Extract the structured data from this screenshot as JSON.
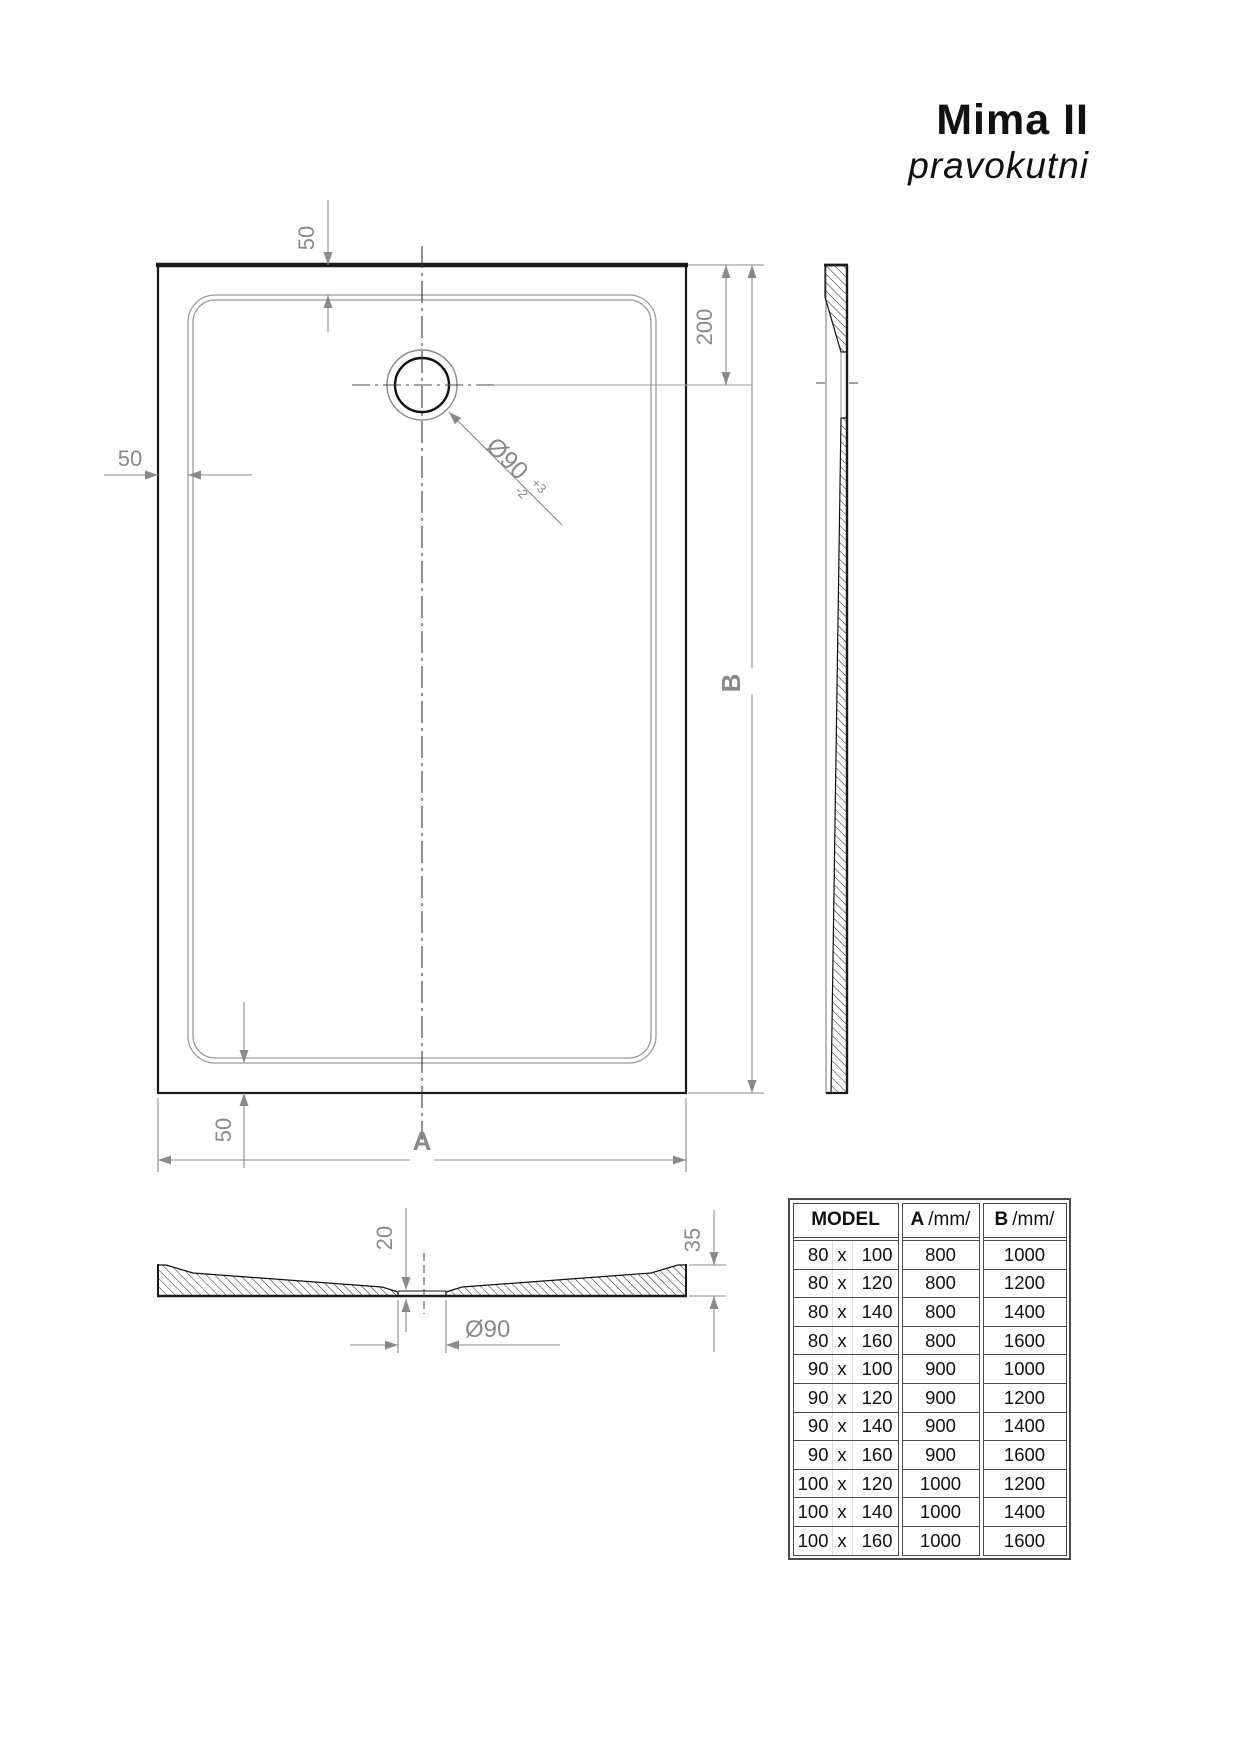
{
  "title": {
    "product": "Mima II",
    "subtitle": "pravokutni"
  },
  "drawing": {
    "top_view": {
      "dim_top_edge_to_rim": "50",
      "dim_left_edge_to_rim": "50",
      "dim_bottom_rim_to_edge": "50",
      "dim_top_edge_to_drain_center": "200",
      "width_label": "A",
      "length_label": "B",
      "drain": {
        "diameter": "Ø90",
        "tol_upper": "+3",
        "tol_lower": "-2"
      }
    },
    "section_view": {
      "thickness_at_drain": "20",
      "thickness_at_edge": "35",
      "drain_diameter": "Ø90"
    }
  },
  "table": {
    "header": {
      "model": "MODEL",
      "a_label": "A",
      "a_unit": "/mm/",
      "b_label": "B",
      "b_unit": "/mm/"
    },
    "rows": [
      {
        "w": "80",
        "sep": "x",
        "l": "100",
        "a": "800",
        "b": "1000"
      },
      {
        "w": "80",
        "sep": "x",
        "l": "120",
        "a": "800",
        "b": "1200"
      },
      {
        "w": "80",
        "sep": "x",
        "l": "140",
        "a": "800",
        "b": "1400"
      },
      {
        "w": "80",
        "sep": "x",
        "l": "160",
        "a": "800",
        "b": "1600"
      },
      {
        "w": "90",
        "sep": "x",
        "l": "100",
        "a": "900",
        "b": "1000"
      },
      {
        "w": "90",
        "sep": "x",
        "l": "120",
        "a": "900",
        "b": "1200"
      },
      {
        "w": "90",
        "sep": "x",
        "l": "140",
        "a": "900",
        "b": "1400"
      },
      {
        "w": "90",
        "sep": "x",
        "l": "160",
        "a": "900",
        "b": "1600"
      },
      {
        "w": "100",
        "sep": "x",
        "l": "120",
        "a": "1000",
        "b": "1200"
      },
      {
        "w": "100",
        "sep": "x",
        "l": "140",
        "a": "1000",
        "b": "1400"
      },
      {
        "w": "100",
        "sep": "x",
        "l": "160",
        "a": "1000",
        "b": "1600"
      }
    ]
  },
  "colors": {
    "line": "#1a1a1a",
    "dim": "#8a8a8a",
    "table_border": "#4a4a4a"
  }
}
